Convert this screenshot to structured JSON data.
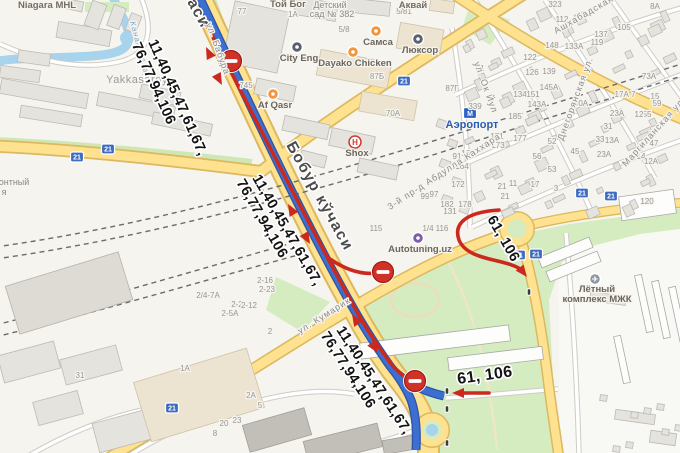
{
  "map": {
    "colors": {
      "route_blue": "#3d6fd2",
      "route_blue_casing": "#2c55a5",
      "route_red": "#cb291e",
      "road_yellow": "#ffe28f",
      "road_yellow_casing": "#dcb85e",
      "water": "#a8d3ed",
      "park": "#d5ecc1",
      "sign_blue": "#3f6cc0"
    },
    "annotations": {
      "routes_main_line1": "11,40,45,47,61,67,",
      "routes_main_line2": "76,77,94,106",
      "routes_secondary": "61, 106",
      "street_main": "Бобур кўчаси",
      "street_main_partial": "аси",
      "road_sign": "21",
      "metro_letter": "M",
      "hotel_letter": "H",
      "airplane_glyph": "✈"
    },
    "annotation_positions": {
      "main": [
        {
          "x": 148,
          "y": 42,
          "r": 66
        },
        {
          "x": 252,
          "y": 178,
          "r": 60
        },
        {
          "x": 336,
          "y": 330,
          "r": 57
        }
      ],
      "secondary": [
        {
          "x": 487,
          "y": 219,
          "r": 60,
          "big": 0
        },
        {
          "x": 458,
          "y": 384,
          "r": -8,
          "big": 1
        }
      ]
    },
    "signs_21": [
      [
        77,
        157
      ],
      [
        108,
        149
      ],
      [
        404,
        81
      ],
      [
        582,
        193
      ],
      [
        611,
        196
      ],
      [
        519,
        255
      ],
      [
        536,
        254
      ],
      [
        172,
        408
      ]
    ],
    "no_entry": [
      [
        231,
        61
      ],
      [
        383,
        272
      ],
      [
        415,
        381
      ]
    ],
    "bus_stops": [
      [
        447,
        391
      ],
      [
        447,
        409
      ],
      [
        447,
        443
      ],
      [
        529,
        292
      ]
    ],
    "pois": [
      {
        "label": "Самса",
        "x": 376,
        "y": 31,
        "ly": 45,
        "kind": "food"
      },
      {
        "label": "Dayako Chicken",
        "x": 353,
        "y": 52,
        "ly": 66,
        "kind": "food"
      },
      {
        "label": "Люксор",
        "x": 418,
        "y": 39,
        "ly": 53,
        "kind": "dark"
      },
      {
        "label": "City Eng",
        "x": 297,
        "y": 47,
        "ly": 61,
        "kind": "dark"
      },
      {
        "label": "Af Qasr",
        "x": 273,
        "y": 94,
        "ly": 108,
        "kind": "food"
      },
      {
        "label": "Shox",
        "x": 355,
        "y": 142,
        "ly": 156,
        "kind": "hotel"
      },
      {
        "label": "Аэропорт",
        "x": 470,
        "y": 113,
        "ly": 128,
        "kind": "metro"
      },
      {
        "label": "Autotuning.uz",
        "x": 418,
        "y": 238,
        "ly": 252,
        "kind": "auto"
      },
      {
        "label": "Лётный",
        "label2": "комплекс МЖК",
        "x": 595,
        "y": 279,
        "ly": 292,
        "ly2": 302,
        "kind": "air"
      }
    ],
    "streets": [
      {
        "t": "ул. Бабура",
        "x": 206,
        "y": 24,
        "r": 70
      },
      {
        "t": "ул. Кумарик",
        "x": 300,
        "y": 334,
        "r": -32
      },
      {
        "t": "ул. Ок Йул",
        "x": 474,
        "y": 63,
        "r": 70
      },
      {
        "t": "3-й пр-д Абдулла Каххара",
        "x": 390,
        "y": 210,
        "r": -33
      },
      {
        "t": "Ашхабадская ул.",
        "x": 556,
        "y": 34,
        "r": -30
      },
      {
        "t": "Днегорянская ул.",
        "x": 563,
        "y": 141,
        "r": -70
      },
      {
        "t": "Маргиланская ул.",
        "x": 626,
        "y": 167,
        "r": -48
      },
      {
        "t": "Канал Салар",
        "x": 130,
        "y": 22,
        "r": 75,
        "w": 1
      }
    ],
    "places": [
      {
        "t": "Niagara MHL",
        "x": 47,
        "y": 8,
        "k": "brand"
      },
      {
        "t": "Yakkasaroy",
        "x": 137,
        "y": 83,
        "k": "area"
      },
      {
        "t": "Той Бог",
        "x": 288,
        "y": 7,
        "k": "brand"
      },
      {
        "t": "Детский",
        "x": 330,
        "y": 8,
        "k": "plain"
      },
      {
        "t": "сад № 382",
        "x": 332,
        "y": 17,
        "k": "plain"
      },
      {
        "t": "Аквай",
        "x": 413,
        "y": 8,
        "k": "brand"
      },
      {
        "t": "онтный",
        "x": 14,
        "y": 185,
        "k": "plain"
      },
      {
        "t": "я",
        "x": 4,
        "y": 195,
        "k": "plain"
      }
    ],
    "houses": [
      [
        246,
        88,
        "745"
      ],
      [
        293,
        17,
        "1А"
      ],
      [
        404,
        14,
        "5/81"
      ],
      [
        344,
        32,
        "5/8"
      ],
      [
        242,
        14,
        "77"
      ],
      [
        377,
        79,
        "87Б"
      ],
      [
        452,
        91,
        "87Г"
      ],
      [
        393,
        116,
        "70А"
      ],
      [
        480,
        71,
        "91"
      ],
      [
        457,
        159,
        "91"
      ],
      [
        475,
        109,
        "339"
      ],
      [
        515,
        119,
        "185"
      ],
      [
        520,
        97,
        "134"
      ],
      [
        497,
        139,
        "171"
      ],
      [
        520,
        141,
        "177"
      ],
      [
        498,
        148,
        "173"
      ],
      [
        468,
        156,
        "162"
      ],
      [
        462,
        169,
        "164"
      ],
      [
        458,
        187,
        "172"
      ],
      [
        425,
        199,
        "99"
      ],
      [
        434,
        197,
        "97"
      ],
      [
        447,
        207,
        "182"
      ],
      [
        465,
        207,
        "178"
      ],
      [
        450,
        214,
        "131"
      ],
      [
        502,
        189,
        "21"
      ],
      [
        505,
        199,
        "21"
      ],
      [
        513,
        186,
        "11"
      ],
      [
        535,
        187,
        "17"
      ],
      [
        556,
        191,
        "3"
      ],
      [
        552,
        172,
        "53"
      ],
      [
        537,
        159,
        "56"
      ],
      [
        575,
        154,
        "45"
      ],
      [
        604,
        157,
        "23А"
      ],
      [
        641,
        159,
        "14"
      ],
      [
        651,
        164,
        "12А"
      ],
      [
        552,
        144,
        "52"
      ],
      [
        654,
        146,
        "47"
      ],
      [
        655,
        99,
        "15"
      ],
      [
        657,
        106,
        "59"
      ],
      [
        647,
        117,
        "55"
      ],
      [
        639,
        117,
        "12"
      ],
      [
        617,
        116,
        "23А"
      ],
      [
        600,
        142,
        "33"
      ],
      [
        612,
        143,
        "13А"
      ],
      [
        608,
        129,
        "31"
      ],
      [
        625,
        97,
        "17А 7"
      ],
      [
        555,
        7,
        "323"
      ],
      [
        562,
        22,
        "112"
      ],
      [
        552,
        48,
        "148"
      ],
      [
        574,
        49,
        "133А"
      ],
      [
        549,
        74,
        "139"
      ],
      [
        597,
        45,
        "119"
      ],
      [
        624,
        30,
        "105"
      ],
      [
        601,
        37,
        "137"
      ],
      [
        549,
        90,
        "145А"
      ],
      [
        533,
        97,
        "151"
      ],
      [
        537,
        107,
        "143А"
      ],
      [
        581,
        106,
        "30А"
      ],
      [
        649,
        79,
        "73А"
      ],
      [
        655,
        9,
        "8А"
      ],
      [
        647,
        204,
        "120"
      ],
      [
        376,
        231,
        "115"
      ],
      [
        428,
        231,
        "1/4"
      ],
      [
        442,
        231,
        "116"
      ],
      [
        265,
        283,
        "2-16"
      ],
      [
        267,
        292,
        "2-23"
      ],
      [
        237,
        307,
        "2-2"
      ],
      [
        249,
        308,
        "2-12"
      ],
      [
        230,
        316,
        "2-5А"
      ],
      [
        208,
        298,
        "2/4-7А"
      ],
      [
        270,
        334,
        "2"
      ],
      [
        185,
        371,
        "1А"
      ],
      [
        251,
        398,
        "2А"
      ],
      [
        260,
        408,
        "5"
      ],
      [
        237,
        423,
        "23"
      ],
      [
        224,
        426,
        "20"
      ],
      [
        215,
        436,
        "8"
      ],
      [
        80,
        378,
        "31"
      ],
      [
        530,
        60,
        "122"
      ],
      [
        532,
        75,
        "126"
      ]
    ]
  }
}
